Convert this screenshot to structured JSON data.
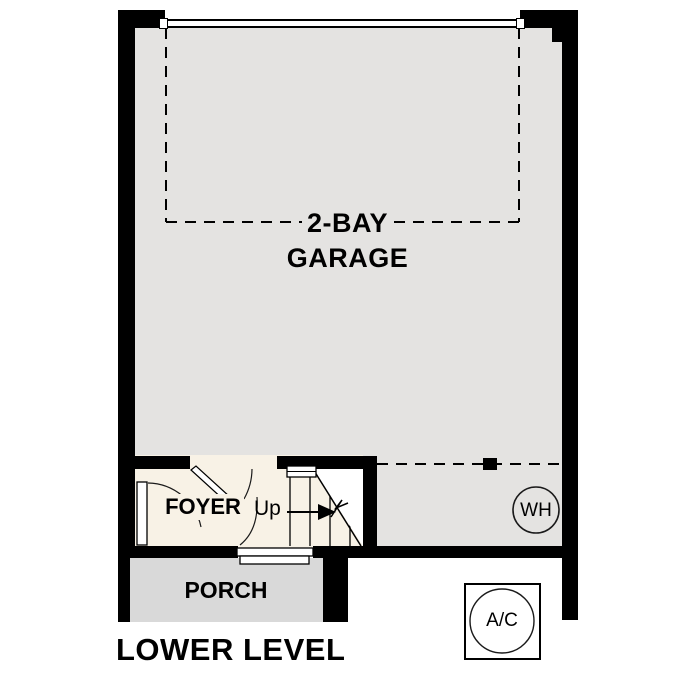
{
  "plan": {
    "title": "LOWER LEVEL",
    "rooms": {
      "garage": {
        "label_line1": "2-BAY",
        "label_line2": "GARAGE"
      },
      "foyer": {
        "label": "FOYER"
      },
      "porch": {
        "label": "PORCH"
      }
    },
    "stairs": {
      "direction_label": "Up"
    },
    "equipment": {
      "water_heater": {
        "label": "WH"
      },
      "air_conditioner": {
        "label": "A/C"
      }
    },
    "colors": {
      "wall": "#000000",
      "garage_floor": "#e4e3e1",
      "foyer_floor": "#f8f2e6",
      "porch_floor": "#d9d9d9",
      "background": "#ffffff"
    }
  }
}
